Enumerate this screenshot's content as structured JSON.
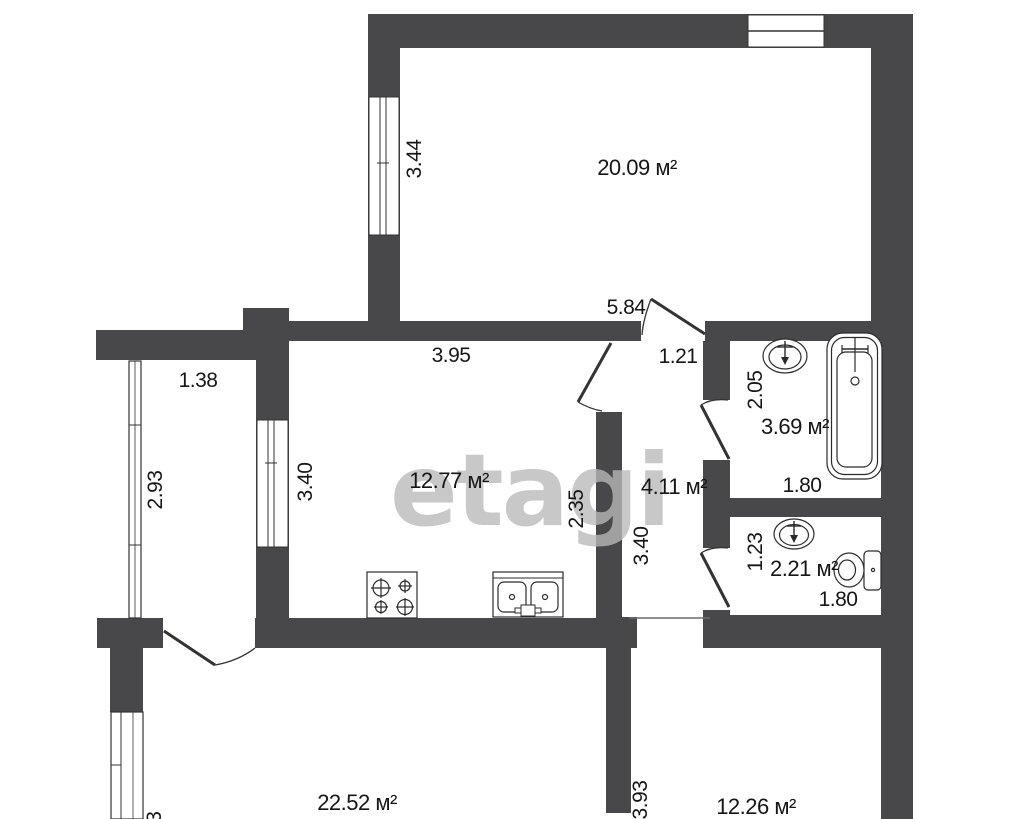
{
  "watermark": "etagi",
  "colors": {
    "wall": "#48484a",
    "text": "#161616",
    "watermark": "#b9b9b9"
  },
  "rooms": {
    "living": {
      "area": "20.09 м²",
      "window_height": "3.44",
      "door_width": "5.84"
    },
    "kitchen": {
      "area": "12.77 м²",
      "top_width": "3.95",
      "left_height": "3.40",
      "right_height": "2.35"
    },
    "balcony": {
      "top_width": "1.38",
      "left_height": "2.93"
    },
    "hallway": {
      "area": "4.11 м²",
      "top_width": "1.21",
      "left_height": "3.40"
    },
    "bathroom": {
      "area": "3.69 м²",
      "left_height": "2.05",
      "bottom_width": "1.80"
    },
    "toilet": {
      "area": "2.21 м²",
      "left_height": "1.23",
      "bottom_width": "1.80"
    },
    "room_bottom_left": {
      "area": "22.52 м²",
      "left_height": "2.93",
      "right_height": "3.93"
    },
    "room_bottom_right": {
      "area": "12.26 м²"
    }
  }
}
